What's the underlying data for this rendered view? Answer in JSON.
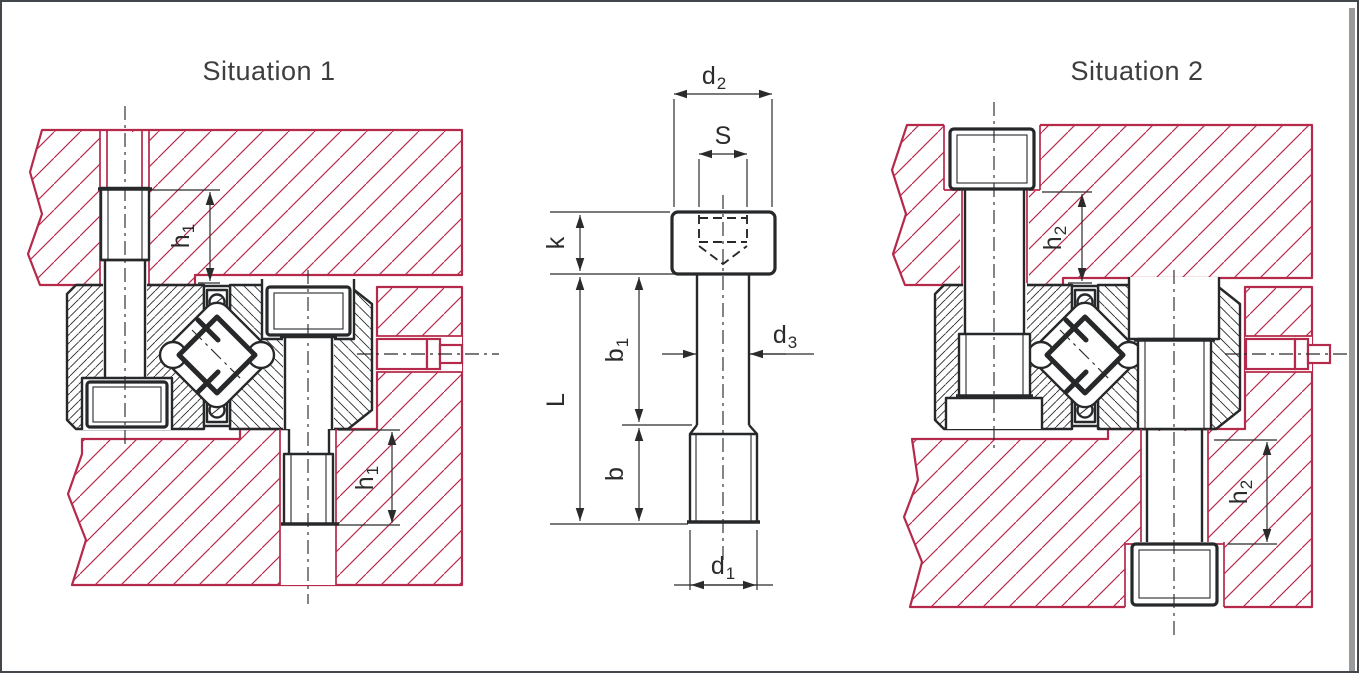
{
  "panels": {
    "situation1": {
      "title": "Situation 1"
    },
    "situation2": {
      "title": "Situation 2"
    }
  },
  "dimensions": {
    "d2": {
      "base": "d",
      "sub": "2"
    },
    "s": {
      "base": "S",
      "sub": ""
    },
    "k": {
      "base": "k",
      "sub": ""
    },
    "L": {
      "base": "L",
      "sub": ""
    },
    "b1": {
      "base": "b",
      "sub": "1"
    },
    "d3": {
      "base": "d",
      "sub": "3"
    },
    "b": {
      "base": "b",
      "sub": ""
    },
    "d1": {
      "base": "d",
      "sub": "1"
    },
    "h1": {
      "base": "h",
      "sub": "1"
    },
    "h2": {
      "base": "h",
      "sub": "2"
    }
  },
  "colors": {
    "customer_part_red": "#b5294a",
    "drawing_black": "#26282a",
    "title_gray": "#3e3e3e"
  }
}
